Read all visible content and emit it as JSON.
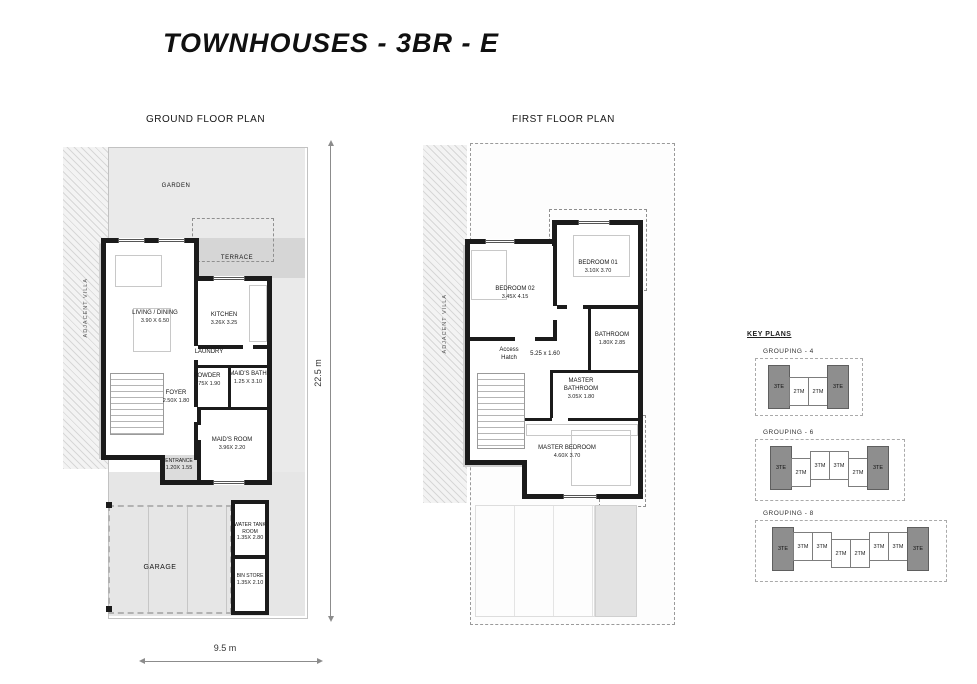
{
  "title": "TOWNHOUSES - 3BR - E",
  "ground_floor": {
    "heading": "GROUND FLOOR PLAN",
    "garden": "GARDEN",
    "terrace": "TERRACE",
    "adjacent_villa": "ADJACENT VILLA",
    "garage": "GARAGE",
    "rooms": {
      "living_dining": {
        "name": "LIVING / DINING",
        "dims": "3.90 X 6.50"
      },
      "kitchen": {
        "name": "KITCHEN",
        "dims": "3.26X 3.25"
      },
      "laundry": {
        "name": "LAUNDRY"
      },
      "powder": {
        "name": "POWDER",
        "dims": "1.75X 1.90"
      },
      "maids_bath": {
        "name": "MAID'S BATH",
        "dims": "1.25 X 3.10"
      },
      "foyer": {
        "name": "FOYER",
        "dims": "2.50X 1.80"
      },
      "entrance": {
        "name": "ENTRANCE",
        "dims": "1.20X 1.55"
      },
      "maids_room": {
        "name": "MAID'S ROOM",
        "dims": "3.96X 2.20"
      },
      "water_tank_room": {
        "name": "WATER TANK ROOM",
        "dims": "1.35X 2.80"
      },
      "bin_store": {
        "name": "BIN STORE",
        "dims": "1.35X 2.10"
      }
    },
    "dim_vertical": "22.5 m",
    "dim_horizontal": "9.5 m"
  },
  "first_floor": {
    "heading": "FIRST FLOOR PLAN",
    "adjacent_villa": "ADJACENT VILLA",
    "access_hatch": "Access Hatch",
    "corridor_dims": "5.25 x 1.60",
    "rooms": {
      "bedroom_02": {
        "name": "BEDROOM 02",
        "dims": "3.45X 4.15"
      },
      "bedroom_01": {
        "name": "BEDROOM 01",
        "dims": "3.10X 3.70"
      },
      "bathroom": {
        "name": "BATHROOM",
        "dims": "1.80X 2.85"
      },
      "master_bathroom": {
        "name": "MASTER BATHROOM",
        "dims": "3.05X 1.80"
      },
      "master_bedroom": {
        "name": "MASTER BEDROOM",
        "dims": "4.60X 3.70"
      }
    }
  },
  "key_plans": {
    "heading": "KEY PLANS",
    "groupings": [
      {
        "label": "GROUPING - 4",
        "units": [
          "3TE",
          "2TM",
          "2TM",
          "3TE"
        ]
      },
      {
        "label": "GROUPING - 6",
        "units": [
          "3TE",
          "2TM",
          "3TM",
          "3TM",
          "2TM",
          "3TE"
        ]
      },
      {
        "label": "GROUPING - 8",
        "units": [
          "3TE",
          "3TM",
          "3TM",
          "2TM",
          "2TM",
          "3TM",
          "3TM",
          "3TE"
        ]
      }
    ]
  },
  "colors": {
    "wall": "#1b1b1b",
    "garden_fill": "#eaeaea",
    "terrace_fill": "#d6d6d6",
    "key_plan_unit_dark": "#8e8e8e"
  }
}
